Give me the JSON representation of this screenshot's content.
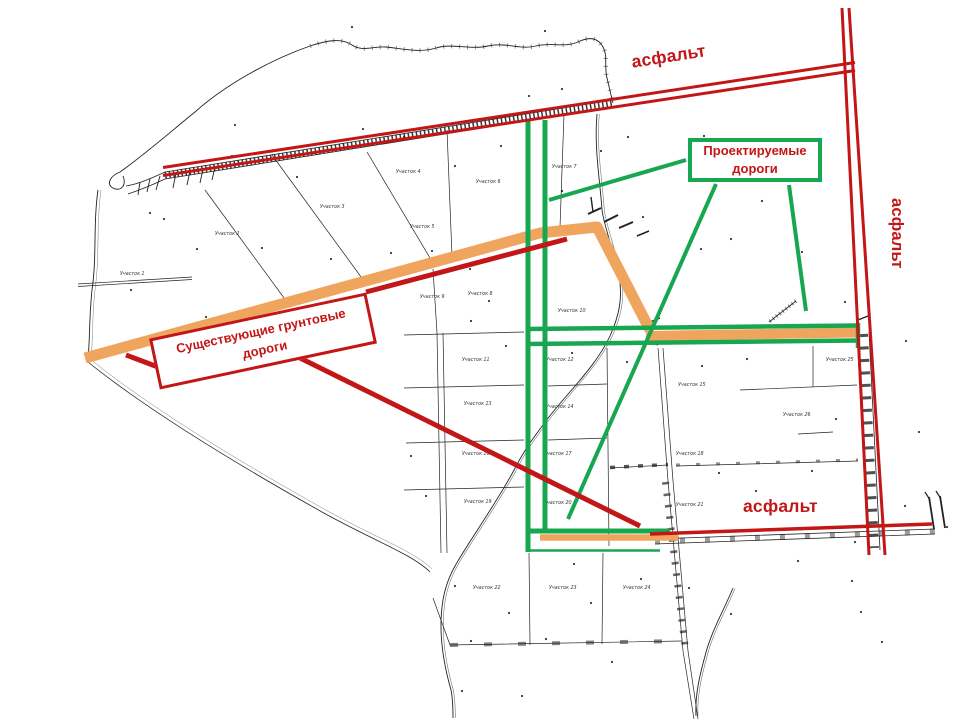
{
  "colors": {
    "red": "#c31616",
    "green": "#18a750",
    "orange": "#f0a55e"
  },
  "labels": {
    "asphalt_top": "асфальт",
    "asphalt_right": "асфальт",
    "asphalt_bottom": "асфальт"
  },
  "legend": {
    "projected": {
      "line1": "Проектируемые",
      "line2": "дороги"
    },
    "existing": {
      "line1": "Существующие грунтовые",
      "line2": "дороги"
    }
  },
  "map": {
    "parcels": [
      {
        "label": "Участок 1"
      },
      {
        "label": "Участок 2"
      },
      {
        "label": "Участок 3"
      },
      {
        "label": "Участок 4"
      },
      {
        "label": "Участок 5"
      },
      {
        "label": "Участок 6"
      },
      {
        "label": "Участок 7"
      },
      {
        "label": "Участок 8"
      },
      {
        "label": "Участок 9"
      },
      {
        "label": "Участок 10"
      },
      {
        "label": "Участок 11"
      },
      {
        "label": "Участок 12"
      },
      {
        "label": "Участок 13"
      },
      {
        "label": "Участок 14"
      },
      {
        "label": "Участок 15"
      },
      {
        "label": "Участок 16"
      },
      {
        "label": "Участок 17"
      },
      {
        "label": "Участок 18"
      },
      {
        "label": "Участок 19"
      },
      {
        "label": "Участок 20"
      },
      {
        "label": "Участок 21"
      },
      {
        "label": "Участок 22"
      },
      {
        "label": "Участок 23"
      },
      {
        "label": "Участок 24"
      },
      {
        "label": "Участок 25"
      },
      {
        "label": "Участок 26"
      }
    ]
  }
}
